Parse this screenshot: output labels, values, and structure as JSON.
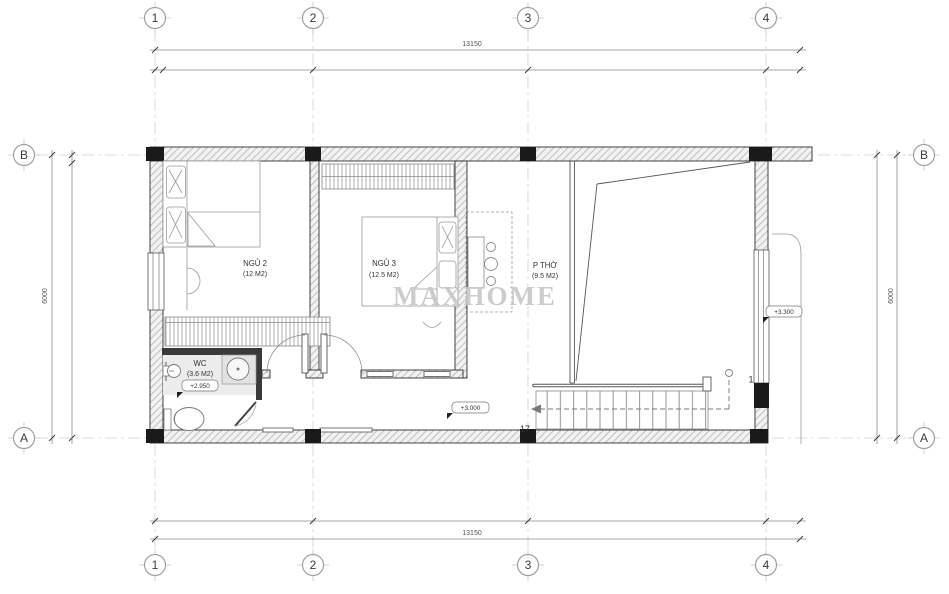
{
  "watermark": "MAXHOME",
  "grid": {
    "cols": [
      "1",
      "2",
      "3",
      "4"
    ],
    "rows": [
      "B",
      "A"
    ]
  },
  "dims": {
    "top": "13150",
    "bottom": "13150",
    "left": "6000",
    "right": "6000"
  },
  "rooms": [
    {
      "name": "NGỦ 2",
      "area": "(12 M2)"
    },
    {
      "name": "NGỦ 3",
      "area": "(12.5 M2)"
    },
    {
      "name": "P THỜ",
      "area": "(9.5 M2)"
    },
    {
      "name": "WC",
      "area": "(3.6 M2)"
    }
  ],
  "levels": {
    "wc": "+2.950",
    "hall": "+3.000",
    "balcony": "+3.300"
  },
  "stairs": {
    "steps": "17",
    "tag": "1"
  },
  "colors": {
    "wall_fill": "#f2f2f2",
    "column": "#1a1a1a",
    "watermark": "#c8c8c8",
    "line": "#555555"
  }
}
